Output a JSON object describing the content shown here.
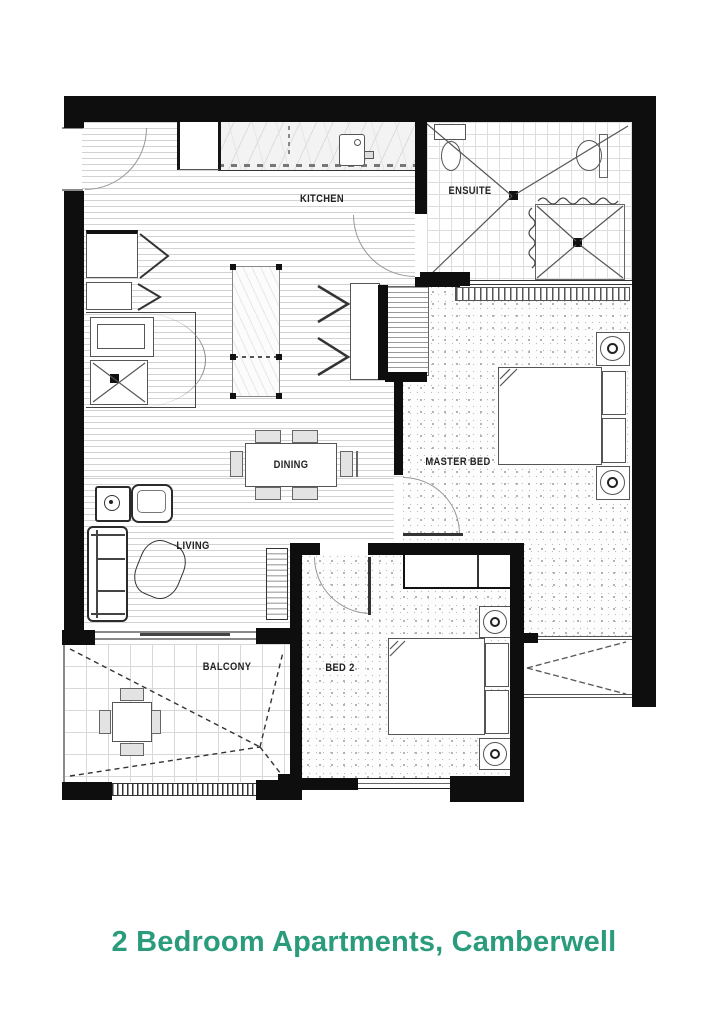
{
  "floorplan": {
    "rooms": {
      "kitchen": "KITCHEN",
      "ensuite": "ENSUITE",
      "master_bed": "MASTER BED",
      "dining": "DINING",
      "living": "LIVING",
      "bed2": "BED 2",
      "balcony": "BALCONY"
    },
    "wall_color": "#0e0e0e",
    "label_color": "#222222"
  },
  "caption": {
    "text": "2 Bedroom Apartments, Camberwell",
    "color": "#2A9C7B"
  }
}
